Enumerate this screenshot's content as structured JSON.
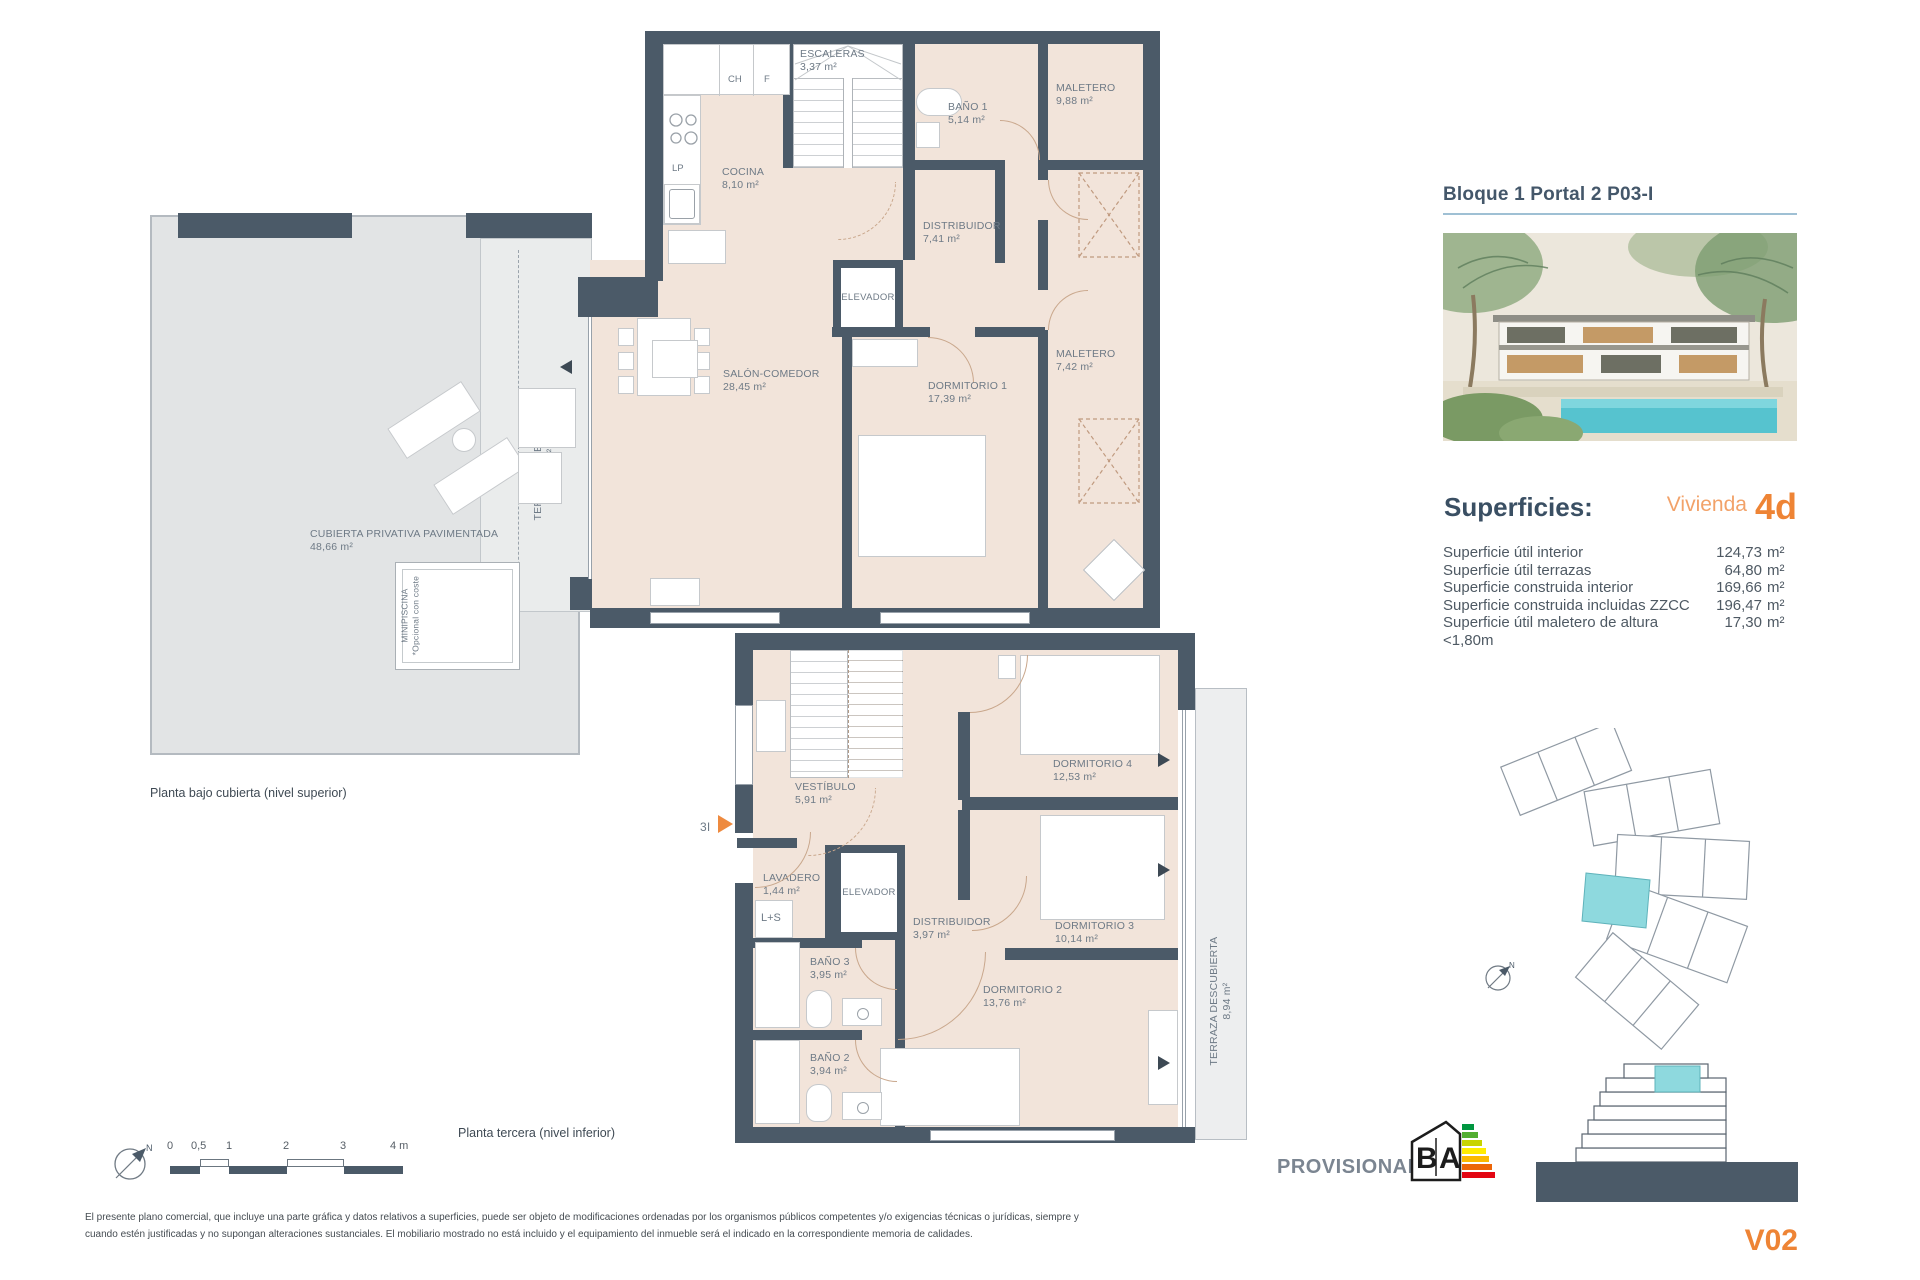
{
  "sidebar": {
    "title": "Bloque 1 Portal 2 P03-I",
    "superficies_heading": "Superficies:",
    "vivienda_label": "Vivienda",
    "vivienda_code": "4d",
    "rows": [
      {
        "label": "Superficie útil interior",
        "value": "124,73",
        "unit": "m²"
      },
      {
        "label": "Superficie útil terrazas",
        "value": "64,80",
        "unit": "m²"
      },
      {
        "label": "Superficie construida interior",
        "value": "169,66",
        "unit": "m²"
      },
      {
        "label": "Superficie construida incluidas ZZCC",
        "value": "196,47",
        "unit": "m²"
      },
      {
        "label": "Superficie útil maletero de altura <1,80m",
        "value": "17,30",
        "unit": "m²"
      }
    ],
    "version_code": "V02"
  },
  "plans": {
    "upper": {
      "caption": "Planta bajo cubierta (nivel superior)",
      "rooms": {
        "escaleras": {
          "name": "ESCALERAS",
          "area": "3,37 m²"
        },
        "cocina": {
          "name": "COCINA",
          "area": "8,10 m²"
        },
        "bano1": {
          "name": "BAÑO 1",
          "area": "5,14 m²"
        },
        "maletero1": {
          "name": "MALETERO",
          "area": "9,88 m²"
        },
        "distribuidor": {
          "name": "DISTRIBUIDOR",
          "area": "7,41 m²"
        },
        "elevador": {
          "name": "ELEVADOR"
        },
        "salon": {
          "name": "SALÓN-COMEDOR",
          "area": "28,45 m²"
        },
        "dormitorio1": {
          "name": "DORMITORIO 1",
          "area": "17,39 m²"
        },
        "maletero2": {
          "name": "MALETERO",
          "area": "7,42 m²"
        },
        "cubierta": {
          "name": "CUBIERTA PRIVATIVA PAVIMENTADA",
          "area": "48,66 m²"
        },
        "terraza_cubierta": {
          "name": "TERRAZA CUBIERTA",
          "area": "7,20 m²"
        },
        "minipiscina": {
          "name": "MINIPISCINA",
          "note": "*Opcional con coste"
        }
      },
      "small": {
        "ch": "CH",
        "f": "F",
        "lp": "LP"
      }
    },
    "lower": {
      "caption": "Planta tercera (nivel inferior)",
      "entry": "3I",
      "rooms": {
        "vestibulo": {
          "name": "VESTÍBULO",
          "area": "5,91 m²"
        },
        "lavadero": {
          "name": "LAVADERO",
          "area": "1,44 m²"
        },
        "elevador": {
          "name": "ELEVADOR"
        },
        "distribuidor": {
          "name": "DISTRIBUIDOR",
          "area": "3,97 m²"
        },
        "dormitorio4": {
          "name": "DORMITORIO 4",
          "area": "12,53 m²"
        },
        "dormitorio3": {
          "name": "DORMITORIO 3",
          "area": "10,14 m²"
        },
        "dormitorio2": {
          "name": "DORMITORIO 2",
          "area": "13,76 m²"
        },
        "bano3": {
          "name": "BAÑO 3",
          "area": "3,95 m²"
        },
        "bano2": {
          "name": "BAÑO 2",
          "area": "3,94 m²"
        },
        "terraza": {
          "name": "TERRAZA DESCUBIERTA",
          "area": "8,94 m²"
        }
      },
      "small": {
        "ls": "L+S"
      }
    }
  },
  "scalebar": {
    "t0": "0",
    "t05": "0,5",
    "t1": "1",
    "t2": "2",
    "t3": "3",
    "t4": "4 m"
  },
  "compass": {
    "north": "N"
  },
  "energy": {
    "provisional": "PROVISIONAL",
    "letter_b": "B",
    "letter_a": "A"
  },
  "footer": {
    "line1": "El presente plano comercial, que incluye una parte gráfica y datos relativos a superficies, puede ser objeto de modificaciones ordenadas por los organismos públicos competentes y/o exigencias técnicas o jurídicas, siempre y",
    "line2": "cuando estén justificadas y no supongan alteraciones sustanciales. El mobiliario mostrado no está incluido y el equipamiento del inmueble será el indicado en la correspondiente memoria de calidades."
  },
  "colors": {
    "wall": "#4b5a68",
    "floor": "#f2e4da",
    "accent_orange": "#ee8435",
    "highlight_cyan": "#8ed9de",
    "title_slate": "#44576a"
  }
}
